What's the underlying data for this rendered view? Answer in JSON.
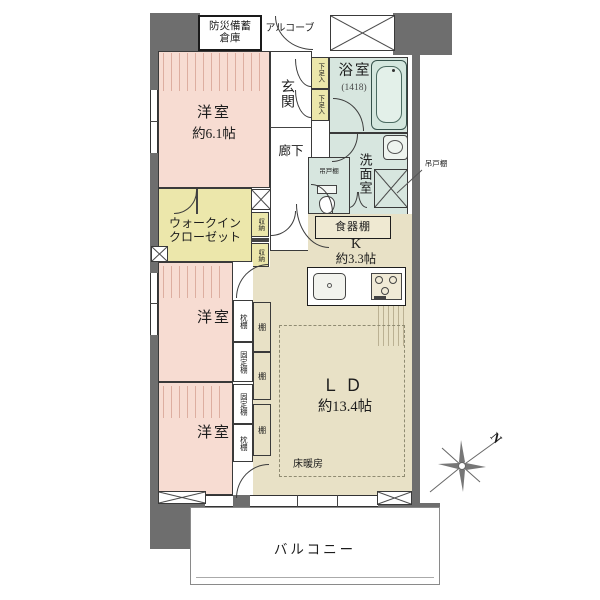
{
  "labels": {
    "disaster_storage_1": "防災備蓄",
    "disaster_storage_2": "倉庫",
    "alcove": "アルコーブ",
    "entrance": "玄関",
    "shoe_box": "下足入",
    "bathroom": "浴室",
    "bathroom_size": "(1418)",
    "corridor": "廊下",
    "washroom": "洗面室",
    "hanging_cabinet": "吊戸棚",
    "western_room": "洋室",
    "western_room_main_size": "約6.1帖",
    "walkin_closet_1": "ウォークイン",
    "walkin_closet_2": "クローゼット",
    "storage": "収納",
    "dish_cabinet": "食器棚",
    "kitchen": "K",
    "kitchen_size": "約3.3帖",
    "pillow_shelf": "枕棚",
    "fixed_shelf": "固定棚",
    "shelf": "棚",
    "living_dining": "ＬＤ",
    "living_dining_size": "約13.4帖",
    "floor_heating": "床暖房",
    "balcony": "バルコニー",
    "north": "N"
  },
  "colors": {
    "wall": "#6e6e6e",
    "western_room": "#f7dcd2",
    "closet_yellow": "#ece7ab",
    "wet_area_teal": "#d7e6df",
    "ld_kitchen_beige": "#e8e1c6",
    "line": "#3a3a3a"
  }
}
